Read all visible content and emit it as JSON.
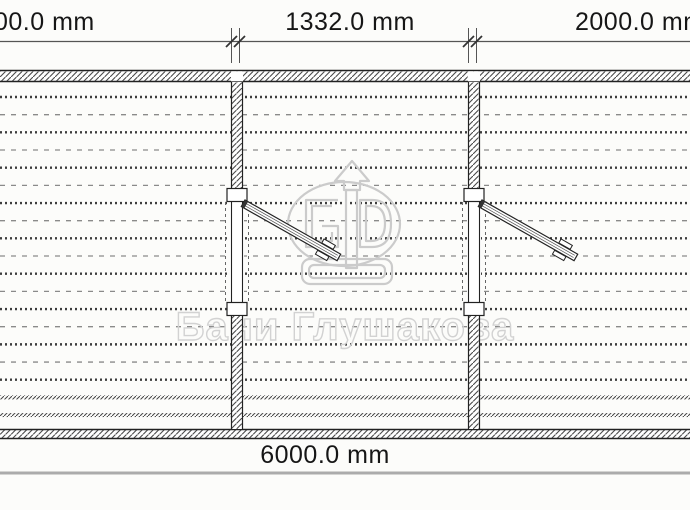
{
  "drawing": {
    "type": "cad-plan-view",
    "dimensions": {
      "top_left_label": "00.0 mm",
      "top_middle_label": "1332.0 mm",
      "top_right_label": "2000.0 mm",
      "bottom_label": "6000.0 mm",
      "unit": "mm"
    },
    "watermark": {
      "brand_text": "Бани Глушакова",
      "logo": "arrow-ellipse-gd-logo"
    },
    "colors": {
      "background": "#fcfcfa",
      "dimension_text": "#161616",
      "dimension_line": "#555555",
      "wall_outline": "#222222",
      "wall_hatch": "#4a4a4a",
      "siding_dark": "#3d3d3d",
      "siding_light": "#8a8a8a",
      "watermark_gray": "#d2d2d2",
      "bottom_rule_gray": "#ababab"
    }
  }
}
